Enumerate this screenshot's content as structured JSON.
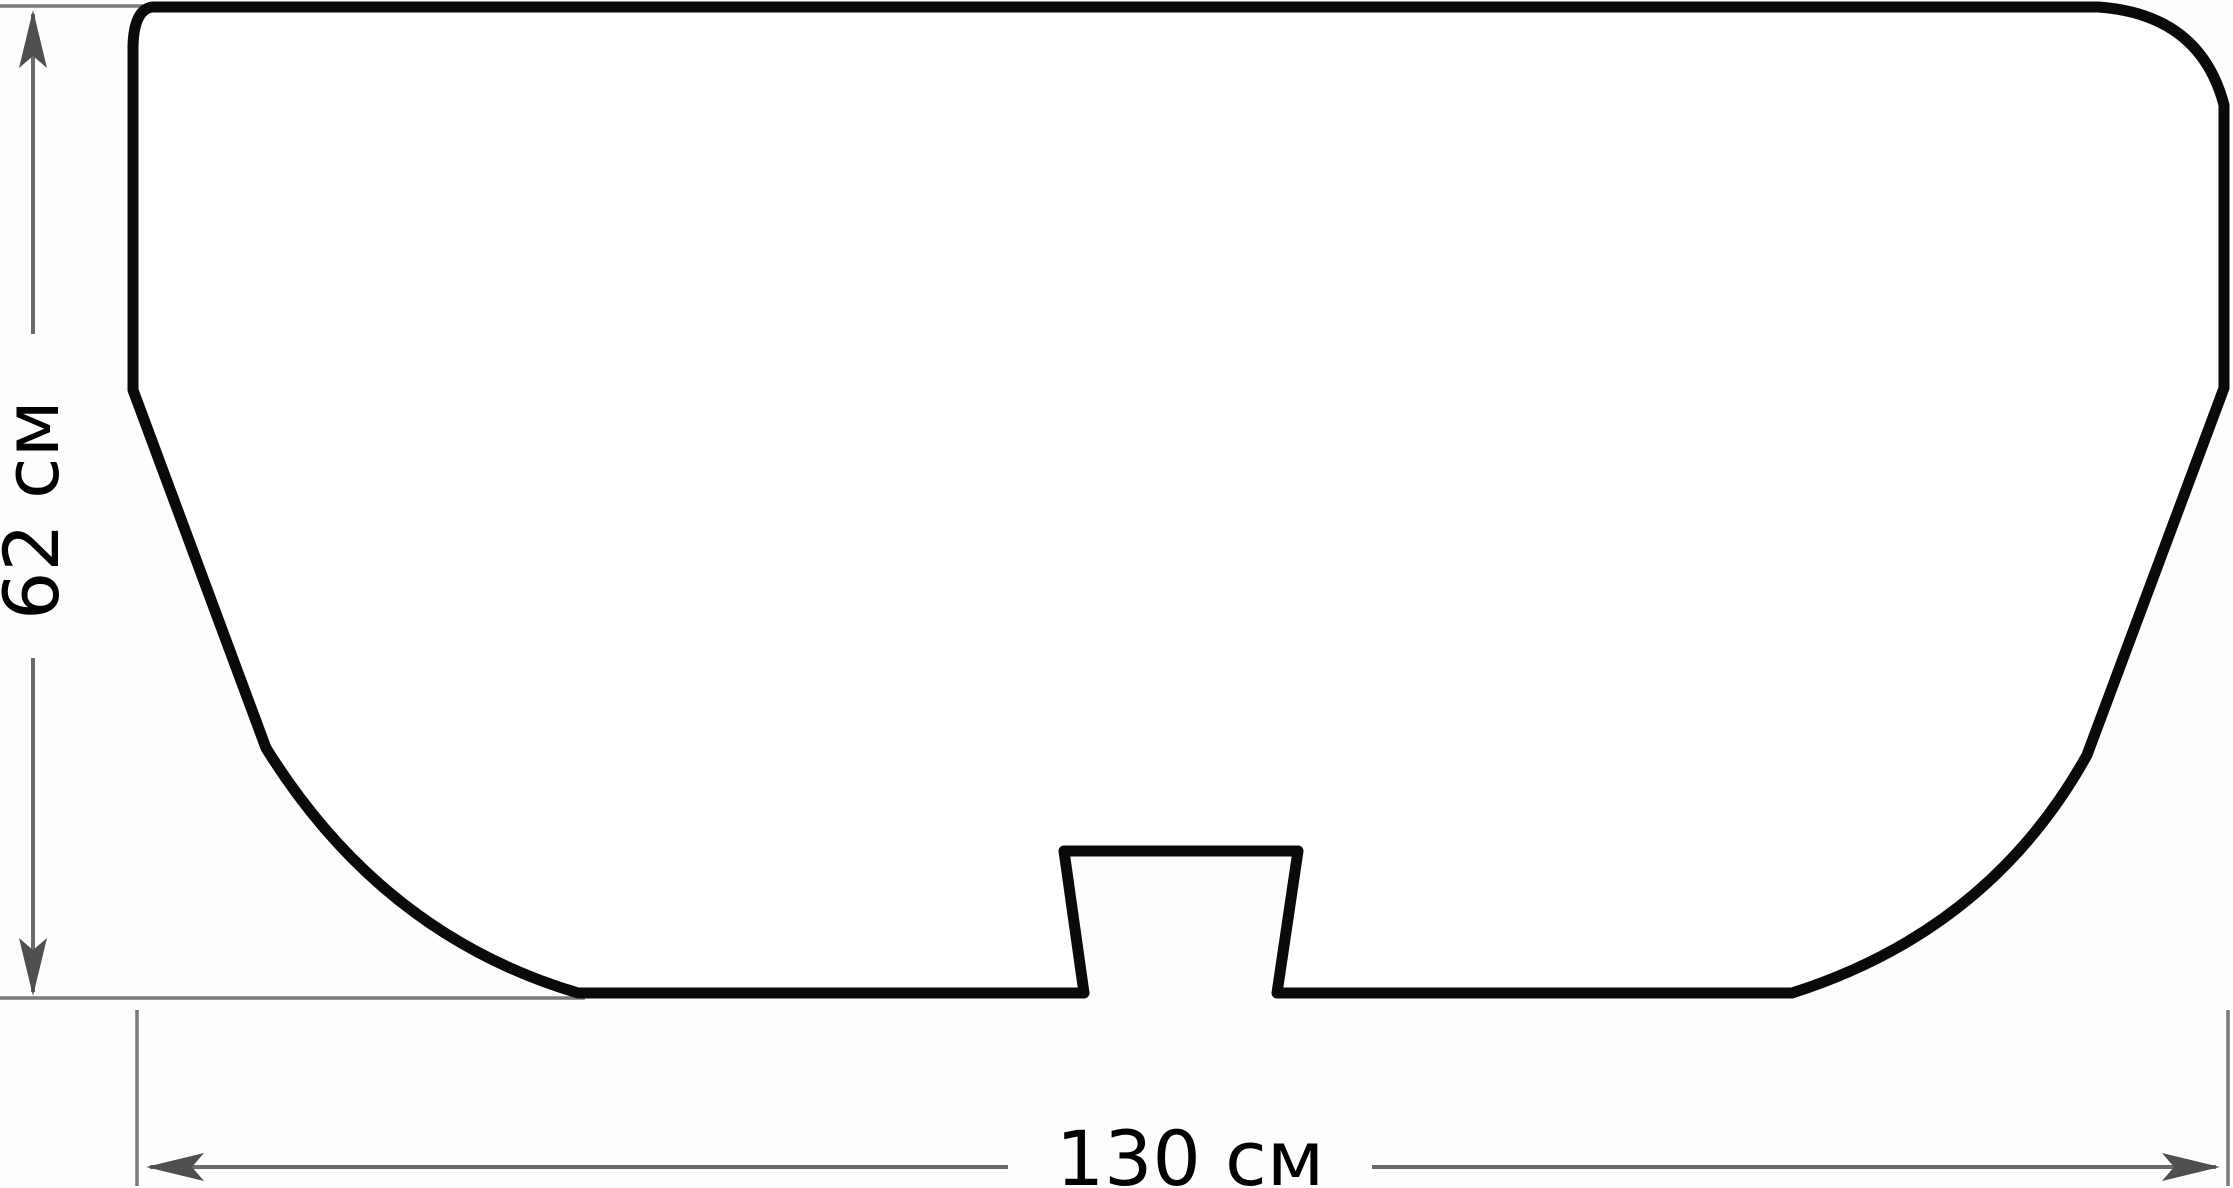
{
  "diagram": {
    "subject": "front-view technical drawing of a basin/bathtub outline with overall dimensions",
    "dimensions": {
      "height": {
        "label": "62 см",
        "value": 62,
        "unit": "см",
        "orientation": "vertical"
      },
      "width": {
        "label": "130 см",
        "value": 130,
        "unit": "см",
        "orientation": "horizontal"
      }
    },
    "colors": {
      "outline": "#0a0a0a",
      "dimension_line": "#6b6b6b",
      "arrow": "#4f4f4f",
      "text": "#000000",
      "background": "#fdfdfd"
    }
  }
}
